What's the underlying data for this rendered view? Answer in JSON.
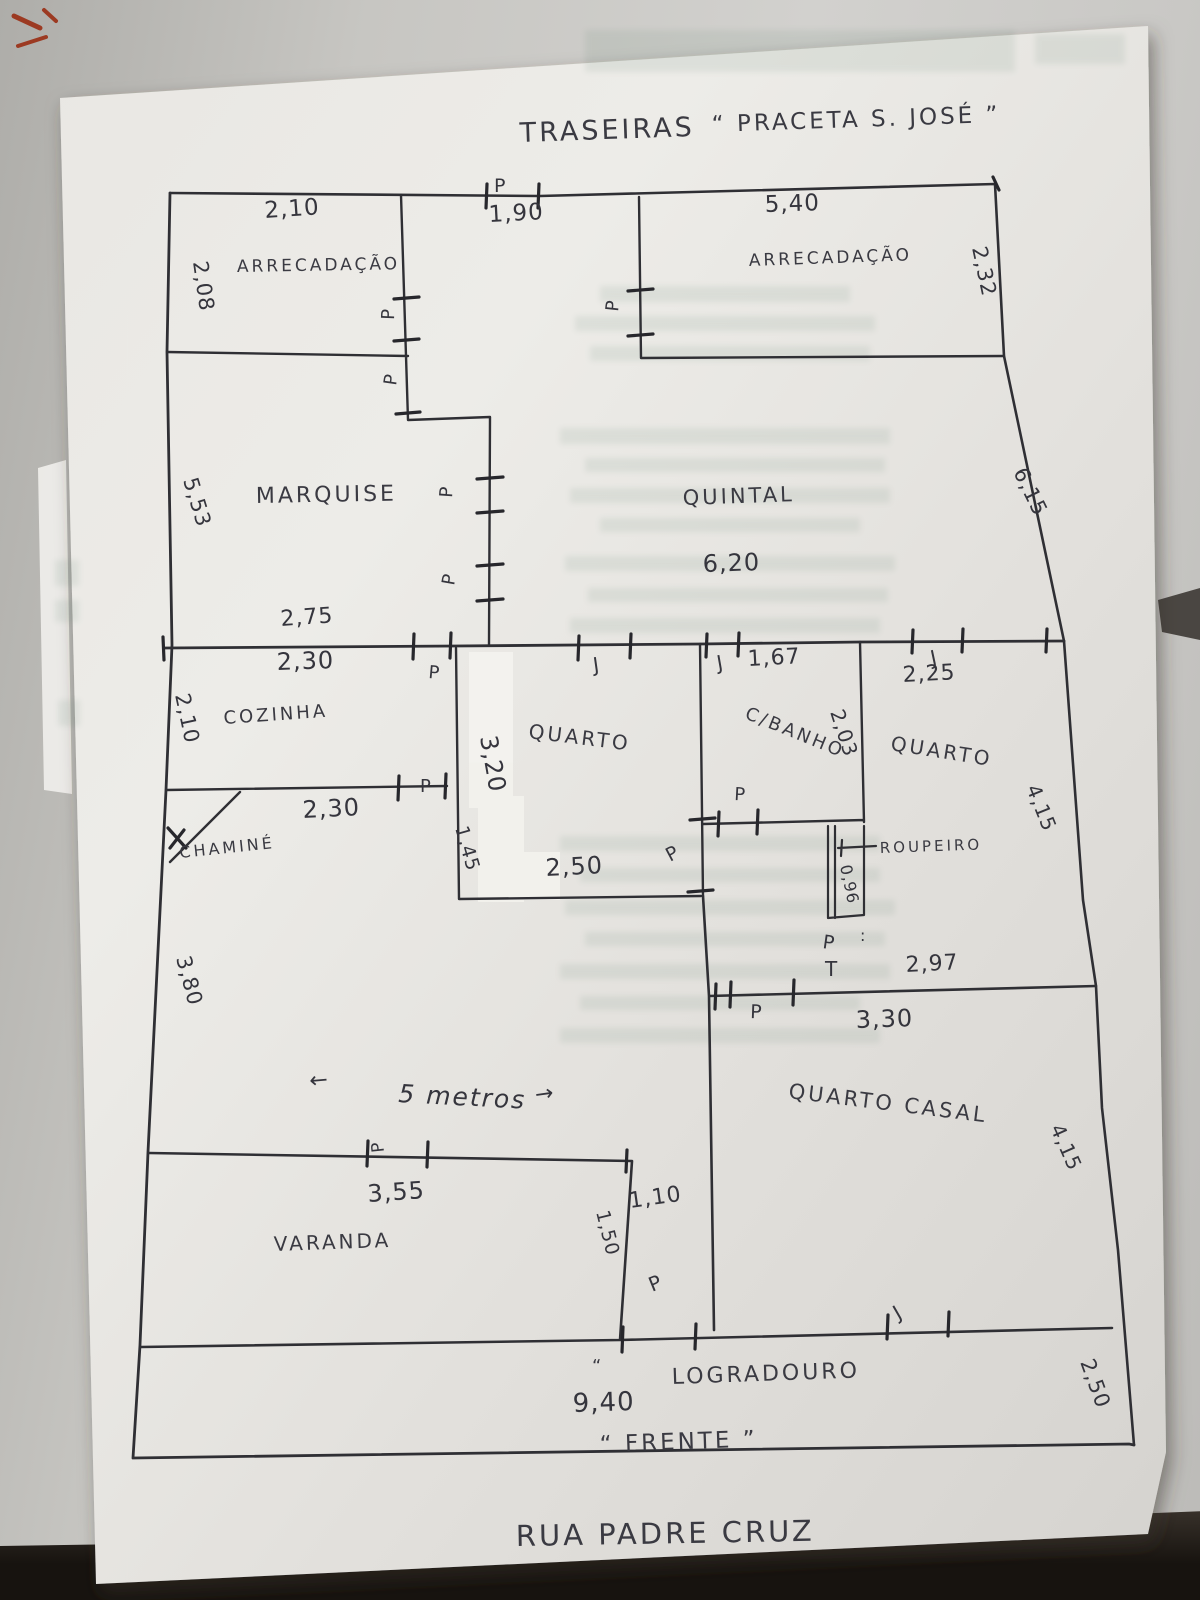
{
  "title_labels": {
    "back": "TRASEIRAS",
    "back_street": "“ PRACETA S. JOSÉ ”",
    "front": "“ FRENTE ”",
    "front_street": "RUA PADRE CRUZ"
  },
  "rooms": {
    "storage_left": "ARRECADAÇÃO",
    "storage_right": "ARRECADAÇÃO",
    "marquise": "MARQUISE",
    "backyard": "QUINTAL",
    "kitchen": "COZINHA",
    "bedroom_center": "QUARTO",
    "bathroom": "C/BANHO",
    "bedroom_right": "QUARTO",
    "wardrobe": "ROUPEIRO",
    "master_bedroom": "QUARTO CASAL",
    "balcony": "VARANDA",
    "chimney": "CHAMINÉ",
    "front_yard": "LOGRADOURO"
  },
  "dimensions": {
    "storage_left_width": "2,10",
    "storage_left_depth": "2,08",
    "back_door_width": "1,90",
    "storage_right_width": "5,40",
    "storage_right_depth": "2,32",
    "marquise_depth": "5,53",
    "backyard_width": "6,20",
    "backyard_depth": "6,15",
    "marquise_bottom": "2,75",
    "kitchen_top": "2,30",
    "kitchen_depth": "2,10",
    "kitchen_bottom": "2,30",
    "bedroom_center_depth": "3,20",
    "bedroom_center_lower": "1,45",
    "bedroom_center_width": "2,50",
    "bathroom_window": "1,67",
    "bedroom_right_window": "2,25",
    "bathroom_depth": "2,03",
    "wardrobe_width": "0,96",
    "bedroom_right_depth": "4,15",
    "living_depth": "3,80",
    "master_top_a": "2,97",
    "master_top_b": "3,30",
    "master_depth": "4,15",
    "balcony_door": "3,55",
    "passage_length": "1,50",
    "passage_width": "1,10",
    "front_width": "9,40",
    "front_yard_depth": "2,50",
    "living_width_note": "5 metros"
  },
  "marks": {
    "door": "P",
    "window": "J",
    "tee": "T",
    "colon": ":",
    "quote": "“",
    "arrow_left": "←",
    "arrow_right": "→"
  },
  "colors": {
    "ink": "#2f2f34",
    "pencil_text": "#3a3a42",
    "paper": "#e8e6e2",
    "backdrop": "#c6c5c1",
    "table_dark": "#1c1712",
    "red_mark": "#9c3a22"
  }
}
